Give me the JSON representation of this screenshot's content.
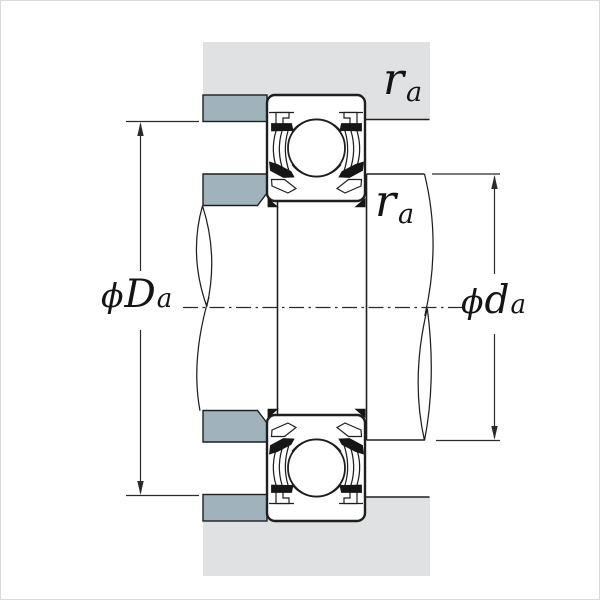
{
  "figure": {
    "description": "Bearing mounting cross-section with abutment and fillet dimensions"
  },
  "labels": {
    "fillet_top": {
      "symbol": "r",
      "sub": "a"
    },
    "fillet_mid": {
      "symbol": "r",
      "sub": "a"
    },
    "housing_dia": {
      "phi": "ϕ",
      "symbol": "D",
      "sub": "a"
    },
    "shaft_dia": {
      "phi": "ϕ",
      "symbol": "d",
      "sub": "a"
    }
  },
  "colors": {
    "housing_gray": "#e0e1e2",
    "shoulder_blue": "#a0b2bc",
    "line_dark": "#1f1f1f",
    "background": "#ffffff"
  }
}
